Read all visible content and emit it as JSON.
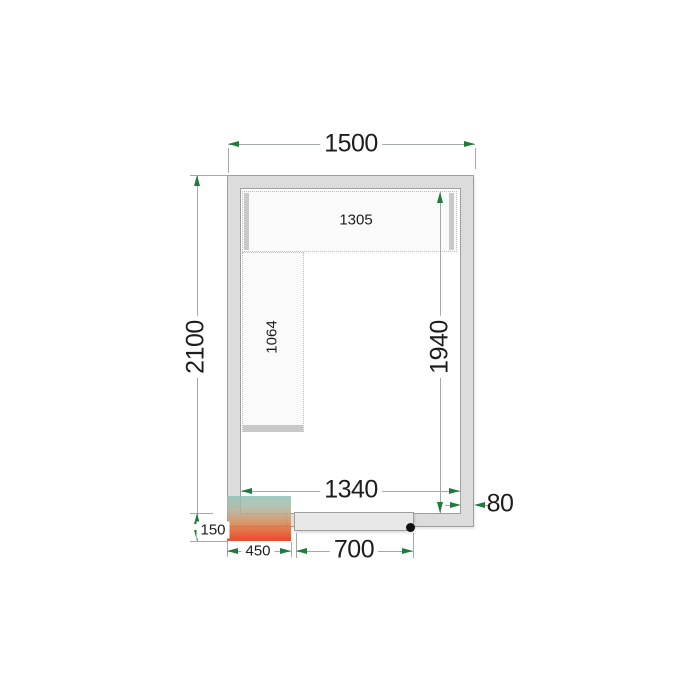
{
  "figure": {
    "kind": "cold-room floor plan, top view"
  },
  "dims": {
    "room_width": "1500",
    "room_depth": "2100",
    "inner_width": "1340",
    "inner_depth": "1940",
    "wall_thickness": "80",
    "top_shelf_length": "1305",
    "left_shelf_length": "1064",
    "cooling_unit_width": "450",
    "cooling_unit_offset": "150",
    "door_width": "700"
  },
  "colors": {
    "wall_fill": "#dcdcdc",
    "wall_stroke": "#9e9e9e",
    "dim_line": "#a6aaa6",
    "arrow_green": "#1e7b3c",
    "heatmap_top": "#8fc4ba",
    "heatmap_bottom": "#e13a14",
    "text": "#1d1d1d"
  }
}
